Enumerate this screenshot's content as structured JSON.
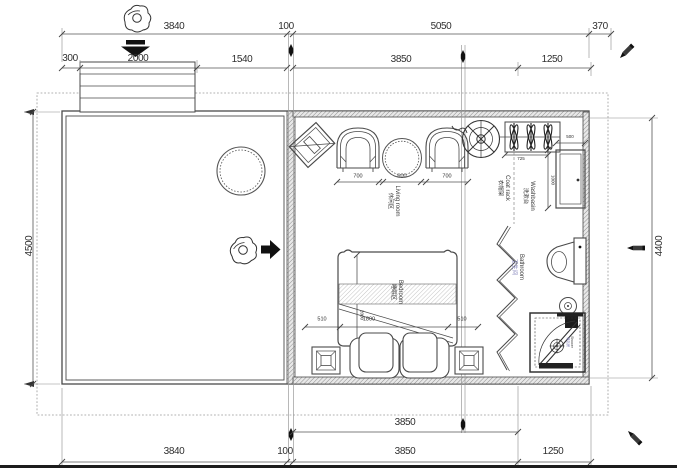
{
  "dims": {
    "top1": [
      "3840",
      "100",
      "5050",
      "370"
    ],
    "top2": [
      "300",
      "2000",
      "1540",
      "3850",
      "1250"
    ],
    "left": "4500",
    "right": "4400",
    "bottom1": "3850",
    "bottom2": [
      "3840",
      "100",
      "3850",
      "1250"
    ],
    "furniture": {
      "chair_l": "700",
      "table": "600",
      "chair_r": "700",
      "coat": "725",
      "basin_w": "500",
      "basin_h": "1000",
      "bed_side_l": "510",
      "bed_w": "1800",
      "bed_side_r": "510",
      "bed_len": "2000"
    }
  },
  "labels": {
    "living": {
      "zh": "休闲区",
      "en": "Living room"
    },
    "coat": {
      "zh": "衣帽架",
      "en": "Coat rack"
    },
    "basin": {
      "zh": "洗漱台",
      "en": "Washbasin"
    },
    "bath": {
      "zh": "卫生间",
      "en": "Bathroom"
    },
    "bed": {
      "zh": "睡眠区",
      "en": "Bedroom"
    },
    "shower": {
      "zh": "淋浴房",
      "en": "Shower"
    }
  },
  "colors": {
    "line": "#4a4a4a",
    "dim_line": "#555555",
    "accent_label": "#7d7db8",
    "paper": "#ffffff"
  }
}
